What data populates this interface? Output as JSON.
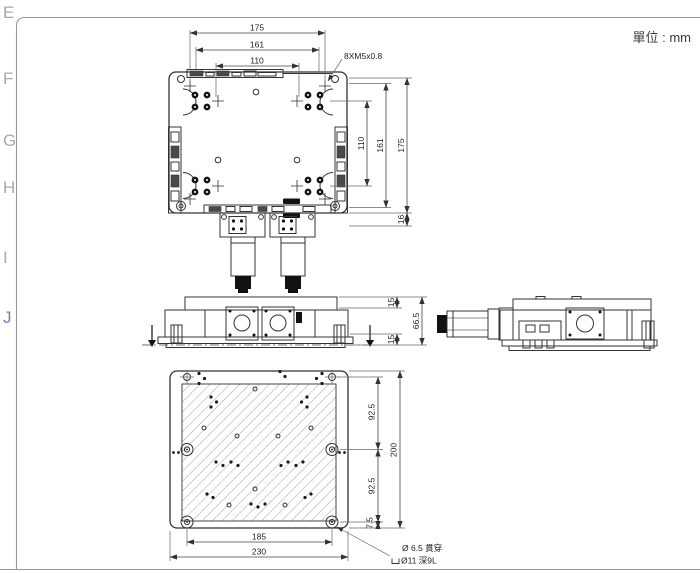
{
  "page": {
    "unit_label": "單位 : mm"
  },
  "frame": {
    "zones": [
      "E",
      "F",
      "G",
      "H",
      "I",
      "J"
    ]
  },
  "views": {
    "top": {
      "thread_note": "8XM5x0.8",
      "dim_width_outer": "175",
      "dim_width_mid": "161",
      "dim_width_inner": "110",
      "dim_height_inner": "110",
      "dim_height_mid": "161",
      "dim_height_outer": "175",
      "dim_rail": "16"
    },
    "front": {
      "dim_top": "15",
      "dim_total": "66.5",
      "dim_bottom": "15"
    },
    "bottom": {
      "dim_hole_rows_top": "92.5",
      "dim_hole_rows_bottom": "92.5",
      "dim_edge_offset": "7.5",
      "dim_height": "200",
      "dim_hole_span": "185",
      "dim_width": "230",
      "hole_note_line1": "Ø 6.5 貫穿",
      "hole_note_line2": "Ø11 深9L"
    }
  },
  "colors": {
    "drawing_line": "#333333",
    "frame_line": "#9a9a9a"
  }
}
